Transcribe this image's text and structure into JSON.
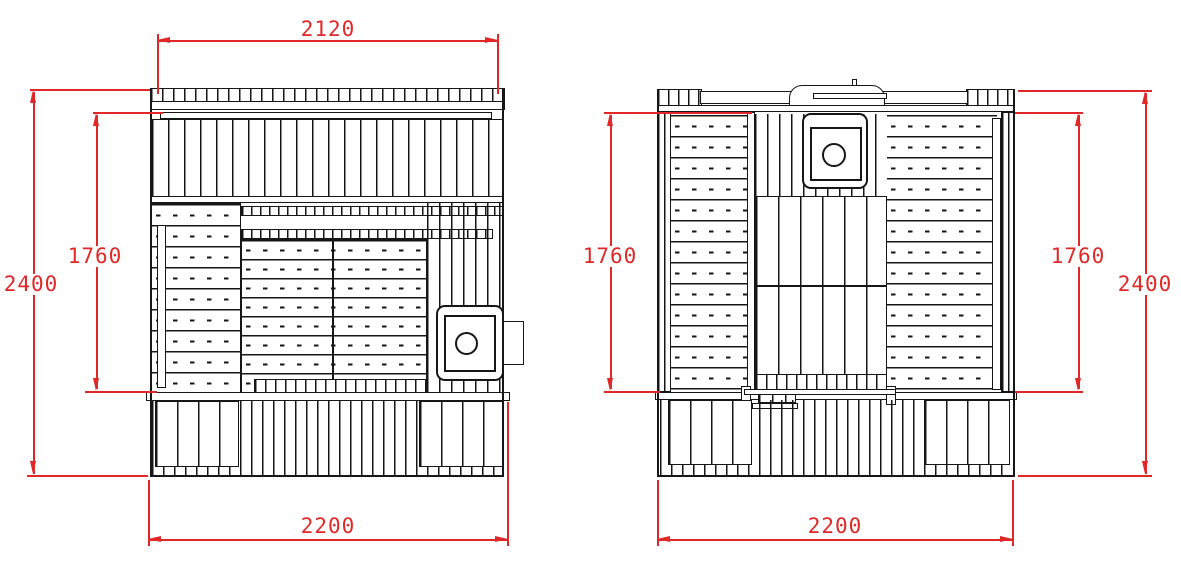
{
  "palette": {
    "background": "#ffffff",
    "line_color": "#161616",
    "dimension_color": "#e02828"
  },
  "drawing": {
    "left_view": {
      "dimensions": {
        "roof_width": "2120",
        "overall_height": "2400",
        "wall_height": "1760",
        "base_width": "2200"
      }
    },
    "right_view": {
      "dimensions": {
        "wall_height_left": "1760",
        "wall_height_right": "1760",
        "overall_height": "2400",
        "base_width": "2200"
      }
    }
  }
}
